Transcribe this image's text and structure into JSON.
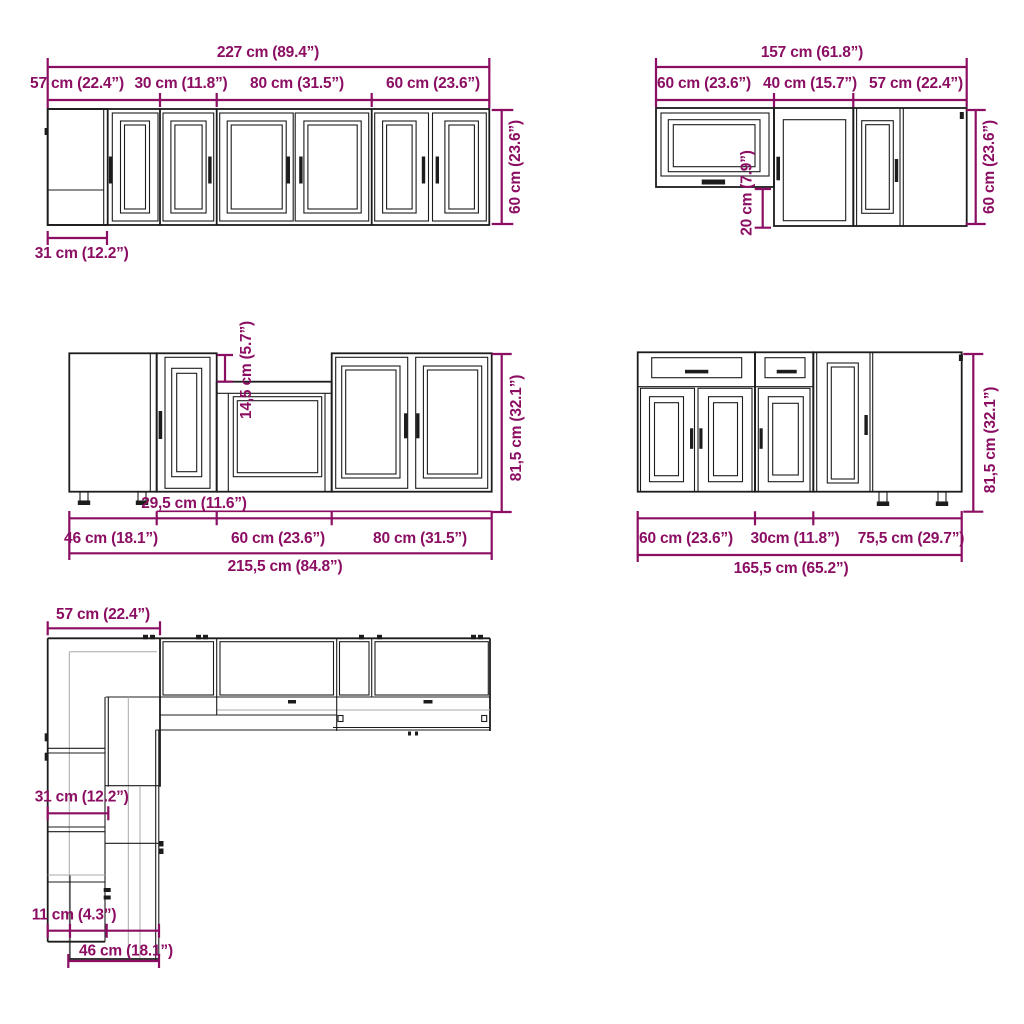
{
  "colors": {
    "dimension": "#8b0e63",
    "cabinet_line": "#1c1c1c",
    "faint_line": "#a9a9a9",
    "background": "#ffffff"
  },
  "diagrams": {
    "wall_row": {
      "total_width": "227 cm (89.4”)",
      "segments": [
        "57 cm (22.4”)",
        "30 cm (11.8”)",
        "80 cm (31.5”)",
        "60 cm (23.6”)"
      ],
      "height": "60 cm (23.6”)",
      "corner_depth": "31 cm (12.2”)"
    },
    "wall_corner": {
      "total_width": "157 cm (61.8”)",
      "segments": [
        "60 cm (23.6”)",
        "40 cm (15.7”)",
        "57 cm (22.4”)"
      ],
      "height": "60 cm (23.6”)",
      "offset": "20 cm (7.9”)"
    },
    "base_row": {
      "sink_offset": "14,5 cm (5.7”)",
      "height": "81,5 cm (32.1”)",
      "filler_width": "29,5 cm (11.6”)",
      "segments": [
        "46 cm (18.1”)",
        "60 cm (23.6”)",
        "80 cm (31.5”)"
      ],
      "total_width": "215,5 cm (84.8”)"
    },
    "base_corner": {
      "segments": [
        "60 cm (23.6”)",
        "30cm (11.8”)",
        "75,5 cm (29.7”)"
      ],
      "height": "81,5 cm (32.1”)",
      "total_width": "165,5 cm (65.2”)"
    },
    "floor_plan": {
      "top_width": "57 cm (22.4”)",
      "corner_depth": "31 cm (12.2”)",
      "offset": "11 cm (4.3”)",
      "base_depth": "46 cm (18.1”)"
    }
  }
}
